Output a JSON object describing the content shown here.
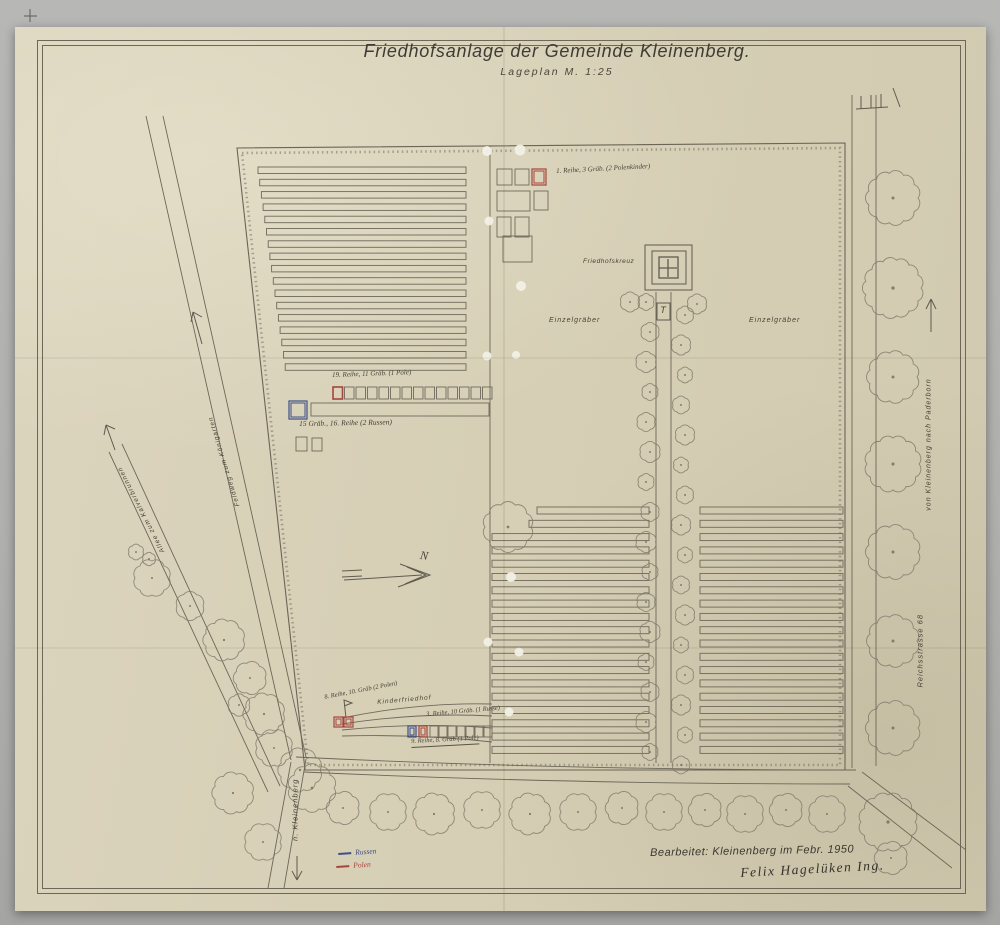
{
  "title": {
    "main": "Friedhofsanlage der Gemeinde Kleinenberg.",
    "sub": "Lageplan  M. 1:25"
  },
  "plan_labels": {
    "friedhofskreuz": "Friedhofskreuz",
    "einzelgraeber_left": "Einzelgräber",
    "einzelgraeber_right": "Einzelgräber",
    "kinderfriedhof": "Kinderfriedhof",
    "north": "N",
    "t_marker": "T"
  },
  "annotations": {
    "top_row": "1. Reihe, 3 Gräb. (2 Polenkinder)",
    "row19": "19. Reihe, 11 Gräb. (1 Pole)",
    "row16": "15 Gräb., 16. Reihe (2 Russen)",
    "row8": "8. Reihe, 10. Gräb (2 Polen)",
    "row3": "3. Reihe, 10 Gräb. (1 Russe)",
    "row9": "9. Reihe, 8. Gräb (1 Pole)"
  },
  "roads": {
    "feldweg": "Feldweg zum Königarten",
    "allee": "Allee zum Kalverbrunnen",
    "paderborn": "von Kleinenberg nach Paderborn",
    "reichsstrasse": "Reichsstrasse 68",
    "kleinenberg": "n. Kleinenberg"
  },
  "legend": {
    "russen": "Russen",
    "polen": "Polen"
  },
  "credits": {
    "prepared": "Bearbeitet:  Kleinenberg im Febr. 1950",
    "signature": "Felix Hagelüken  Ing."
  },
  "colors": {
    "russen": "#3d4f86",
    "polen": "#a6453c",
    "ink": "#5f5b4f",
    "paper": "#d7d0b7"
  }
}
